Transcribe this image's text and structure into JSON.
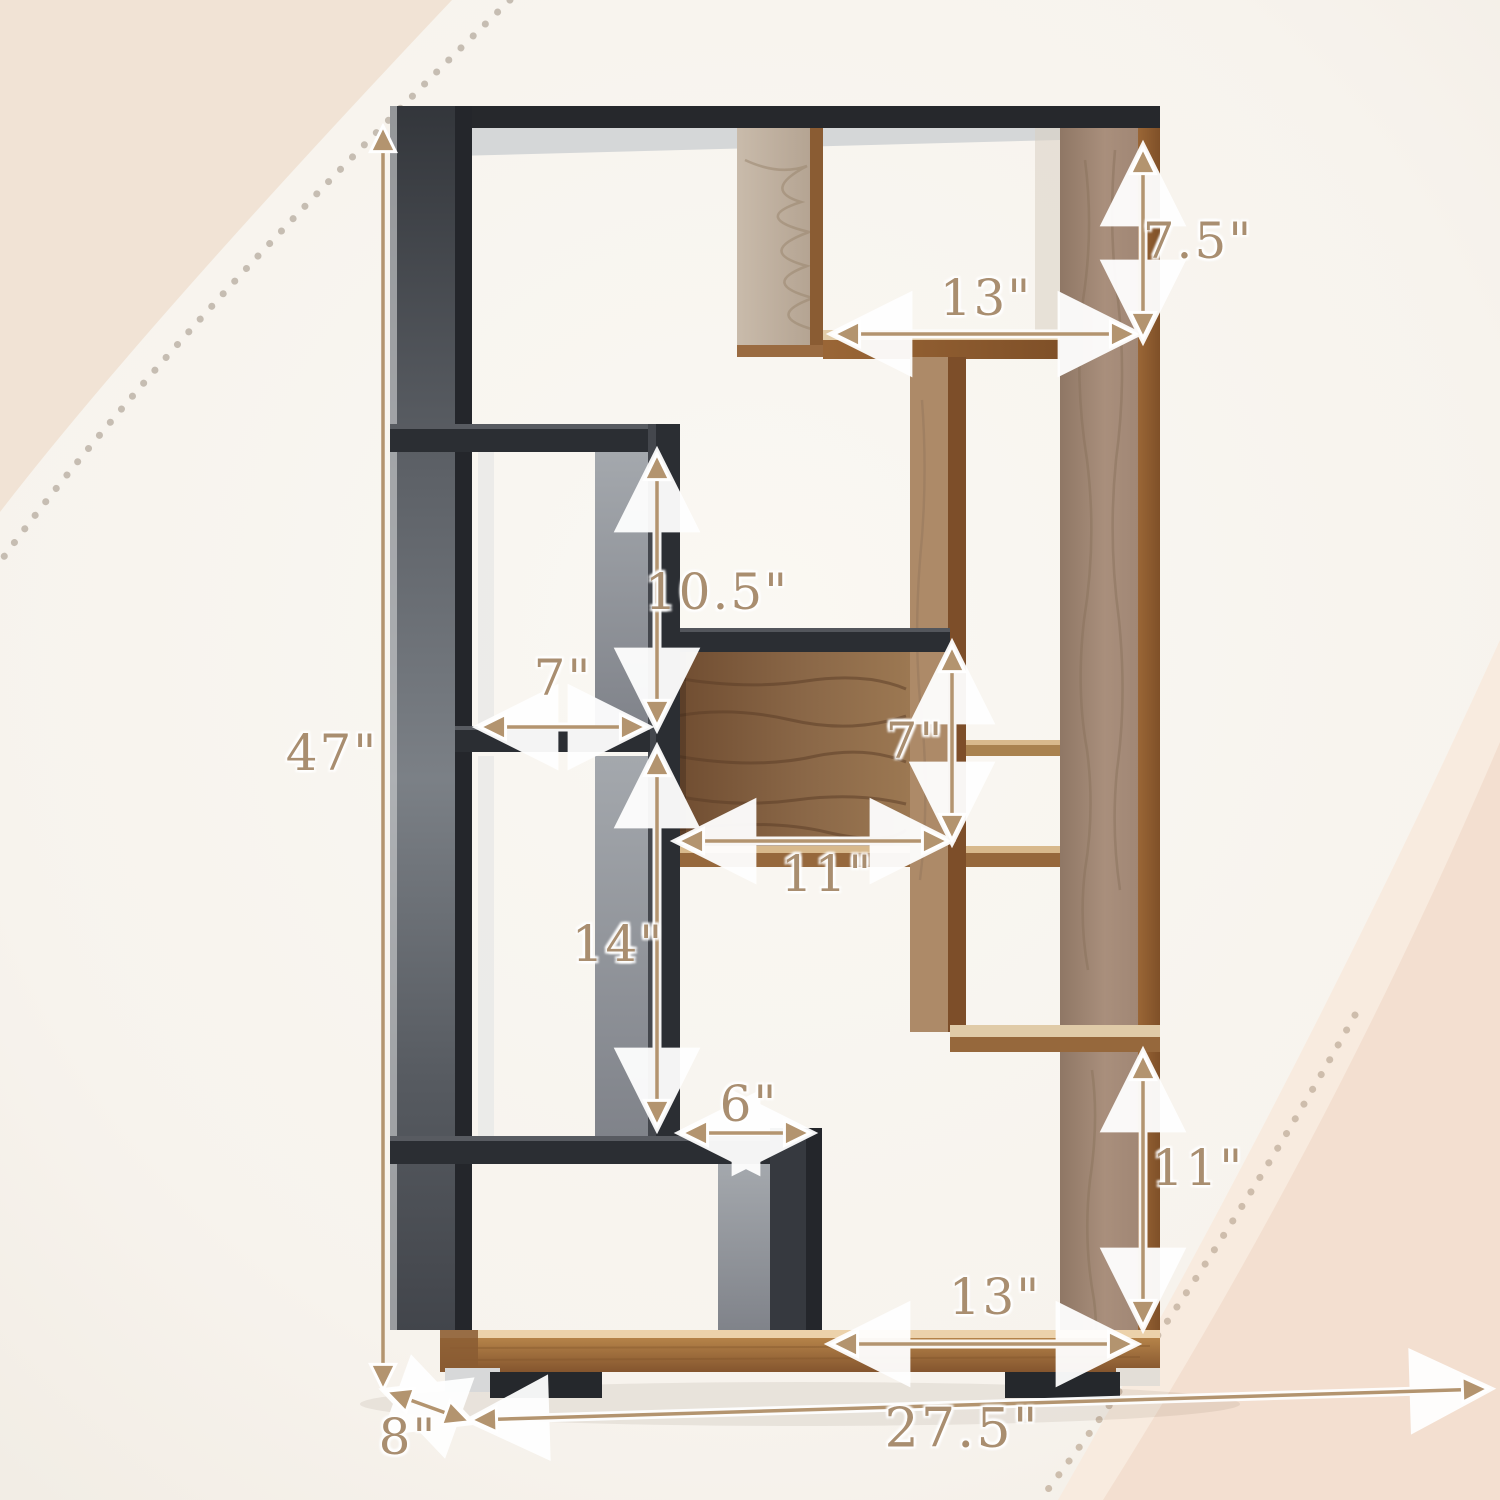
{
  "diagram": {
    "title": "bookshelf-dimension-diagram",
    "product": "8-cube two-tone geometric bookshelf, black and natural wood",
    "dimensions": {
      "overall_height": "47\"",
      "overall_width": "27.5\"",
      "overall_depth": "8\"",
      "top_right_cubby_width": "13\"",
      "top_right_cubby_height": "7.5\"",
      "upper_left_cubby_height": "10.5\"",
      "upper_left_cubby_width": "7\"",
      "center_cubby_height": "7\"",
      "center_cubby_width": "11\"",
      "lower_left_cubby_height": "14\"",
      "bottom_center_gap_width": "6\"",
      "lower_right_cubby_height": "11\"",
      "bottom_right_opening_width": "13\""
    },
    "colors": {
      "dimension_accent": "#a98e70",
      "arrow_fill": "#b3946f",
      "frame_black": "#26282c",
      "frame_gray": "#6b7076",
      "wood_light": "#a98f7c",
      "wood_edge": "#8a5c33",
      "walnut_back": "#8a6747",
      "background": "#f8f5f0",
      "corner_blob": "#f1e3d5"
    }
  }
}
